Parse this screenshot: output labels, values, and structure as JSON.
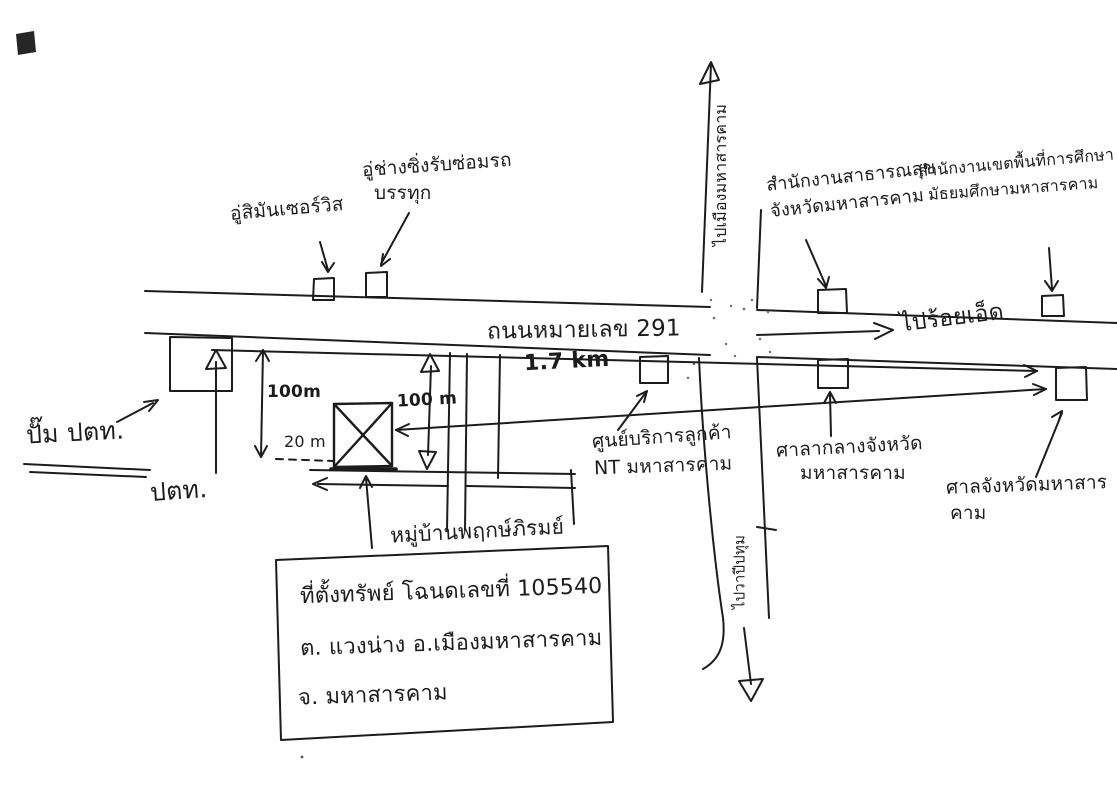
{
  "page": {
    "background": "#ffffff",
    "ink": "#1c1c1c"
  },
  "main_road": {
    "name": "ถนนหมายเลข 291",
    "distance_label": "1.7 km",
    "direction_right": "ไปร้อยเอ็ด"
  },
  "cross_road": {
    "direction_up": "ไปเมืองมหาสารคาม",
    "direction_down": "ไปวาปีปทุม"
  },
  "landmarks": {
    "garage_service": {
      "label": "อู่สิมันเซอร์วิส"
    },
    "truck_garage": {
      "line1": "อู่ช่างซิ่งรับซ่อมรถ",
      "line2": "บรรทุก"
    },
    "public_health_office": {
      "line1": "สำนักงานสาธารณสุข",
      "line2": "จังหวัดมหาสารคาม"
    },
    "education_office": {
      "line1": "สำนักงานเขตพื้นที่การศึกษา",
      "line2": "มัธยมศึกษามหาสารคาม"
    },
    "nt_service_center": {
      "line1": "ศูนย์บริการลูกค้า",
      "line2": "NT มหาสารคาม"
    },
    "provincial_hall": {
      "line1": "ศาลากลางจังหวัด",
      "line2": "มหาสารคาม"
    },
    "provincial_court": {
      "line1": "ศาลจังหวัดมหาสาร",
      "line2": "คาม"
    },
    "ptt_station": {
      "label": "ปั๊ม ปตท.",
      "short_label": "ปตท."
    },
    "village": {
      "label": "หมู่บ้านพฤกษ์ภิรมย์"
    }
  },
  "measurements": {
    "west_depth": "100m",
    "setback": "20 m",
    "east_depth": "100 m"
  },
  "property_note": {
    "line1": "ที่ตั้งทรัพย์ โฉนดเลขที่ 105540",
    "line2": "ต. แวงน่าง อ.เมืองมหาสารคาม",
    "line3": "จ. มหาสารคาม"
  }
}
